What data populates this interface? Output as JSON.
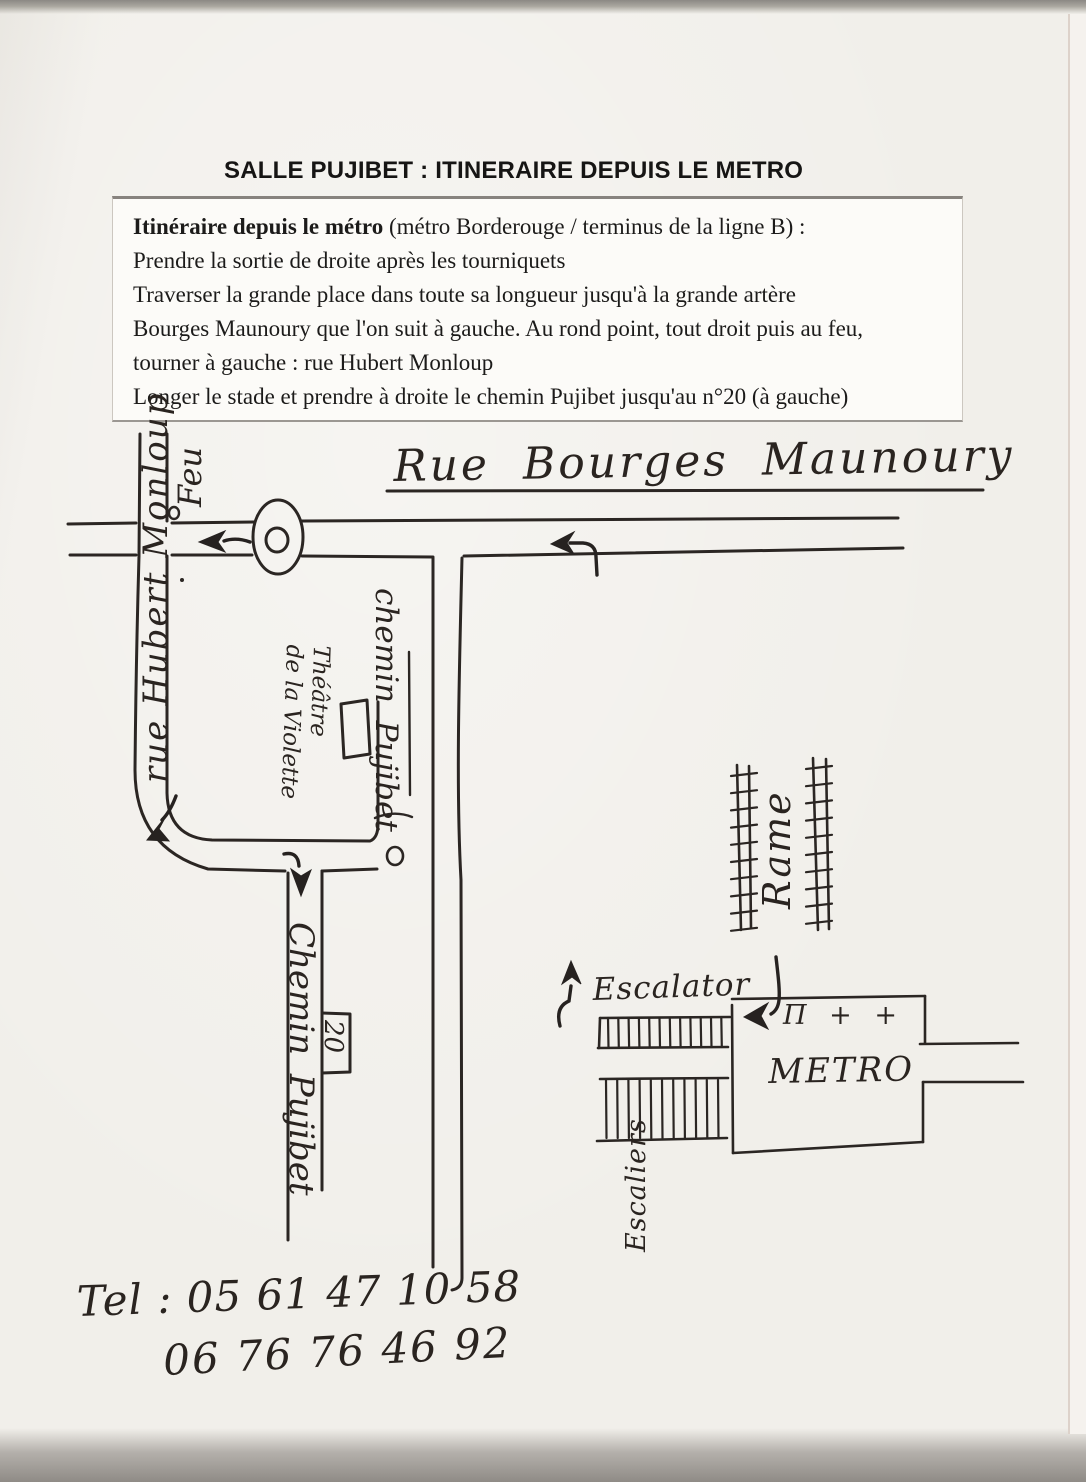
{
  "title": "SALLE PUJIBET : ITINERAIRE DEPUIS LE METRO",
  "instructions": {
    "intro_bold": "Itinéraire depuis le métro",
    "intro_rest": " (métro Borderouge / terminus de la ligne B) :",
    "lines": [
      "Prendre la sortie de droite après les tourniquets",
      "Traverser la grande place dans toute sa longueur jusqu'à la grande artère",
      "Bourges Maunoury que l'on suit à gauche. Au rond point, tout droit puis au feu,",
      "tourner à gauche : rue Hubert Monloup",
      "Longer le stade et prendre à droite le chemin Pujibet jusqu'au n°20 (à gauche)"
    ]
  },
  "map": {
    "street_bourges_maunoury": "Rue Bourges Maunoury",
    "street_hubert_monloup": "rue Hubert Monloup",
    "street_chemin_pujibet_upper": "chemin Pujibet",
    "street_chemin_pujibet_lower": "Chemin Pujibet",
    "traffic_light_label": "Feu",
    "theatre_line1": "Théâtre",
    "theatre_line2": "de la Violette",
    "house_number": "20",
    "rame_label": "Rame",
    "escalator_label": "Escalator",
    "stairs_label": "Escaliers",
    "metro_label": "METRO",
    "metro_symbols": "Π + +"
  },
  "contact": {
    "tel_line1": "Tel : 05 61 47 10 58",
    "tel_line2": "06 76 76 46 92"
  },
  "colors": {
    "ink": "#2b2623",
    "paper": "#f1efea"
  }
}
